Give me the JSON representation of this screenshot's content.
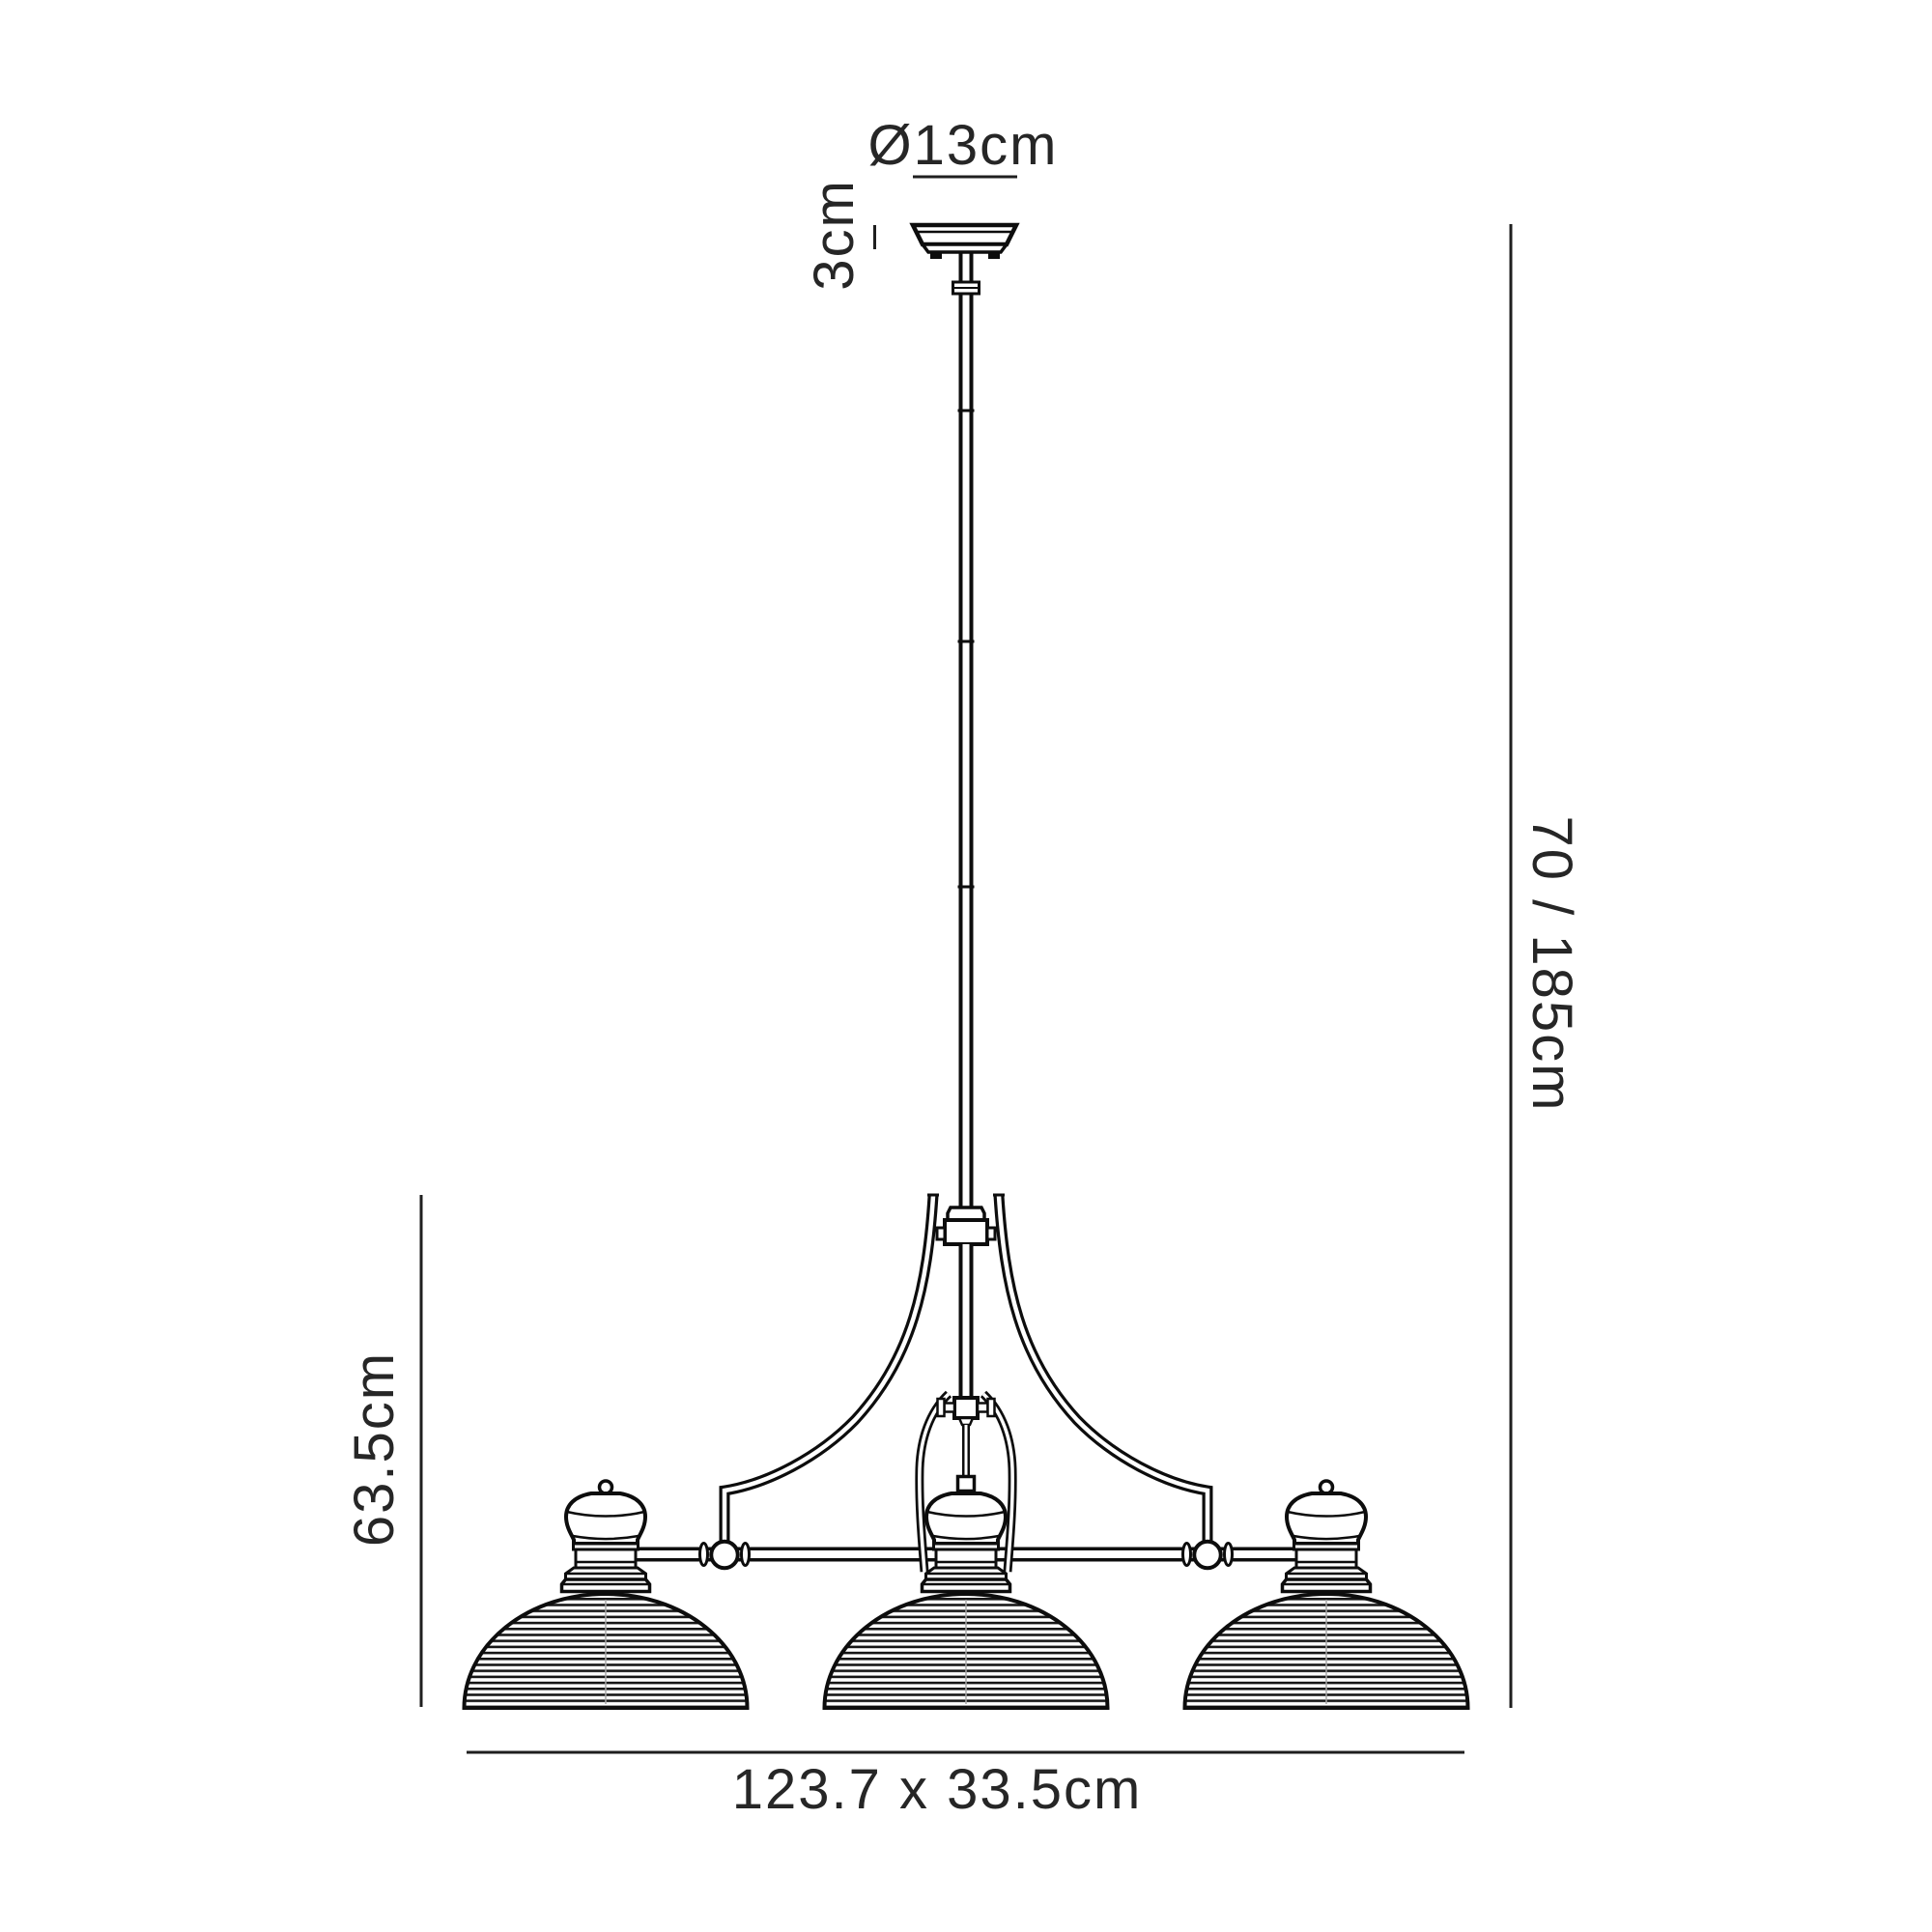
{
  "diagram": {
    "type": "product-dimension-drawing",
    "fixture": {
      "shade_count": 3
    },
    "labels": {
      "canopy_diameter": "Ø13cm",
      "canopy_height": "3cm",
      "overall_drop": "70 / 185cm",
      "body_height": "63.5cm",
      "overall_size": "123.7 x 33.5cm"
    },
    "colors": {
      "line": "#0d0d0d",
      "dimension": "#1f1f1f",
      "label": "#262626",
      "background": "#ffffff"
    }
  }
}
